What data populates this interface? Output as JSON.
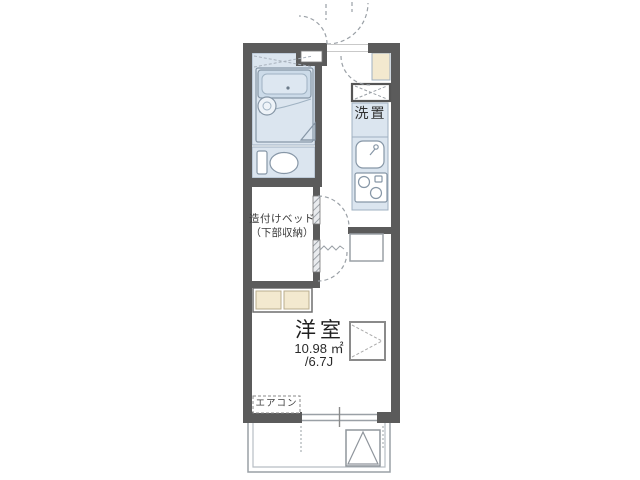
{
  "floorplan": {
    "description": "Japanese one-room apartment floor plan",
    "labels": {
      "main_room_name": "洋室",
      "main_room_area_m2": "10.98 ㎡",
      "main_room_area_tatami": "/6.7J",
      "built_in_bed_line1": "造付けベッド",
      "built_in_bed_line2": "（下部収納）",
      "air_conditioner": "エアコン",
      "washer_space": "洗置"
    },
    "colors": {
      "wall": "#5b5b5b",
      "wet_area_fill": "#dbe5ef",
      "bathtub_fill": "#ccdbe9",
      "storage_fill": "#f3e9cf",
      "fixture_line": "#8696a6",
      "dash_line": "#9aa0a6",
      "text": "#3a3a3a",
      "background": "#ffffff"
    }
  }
}
